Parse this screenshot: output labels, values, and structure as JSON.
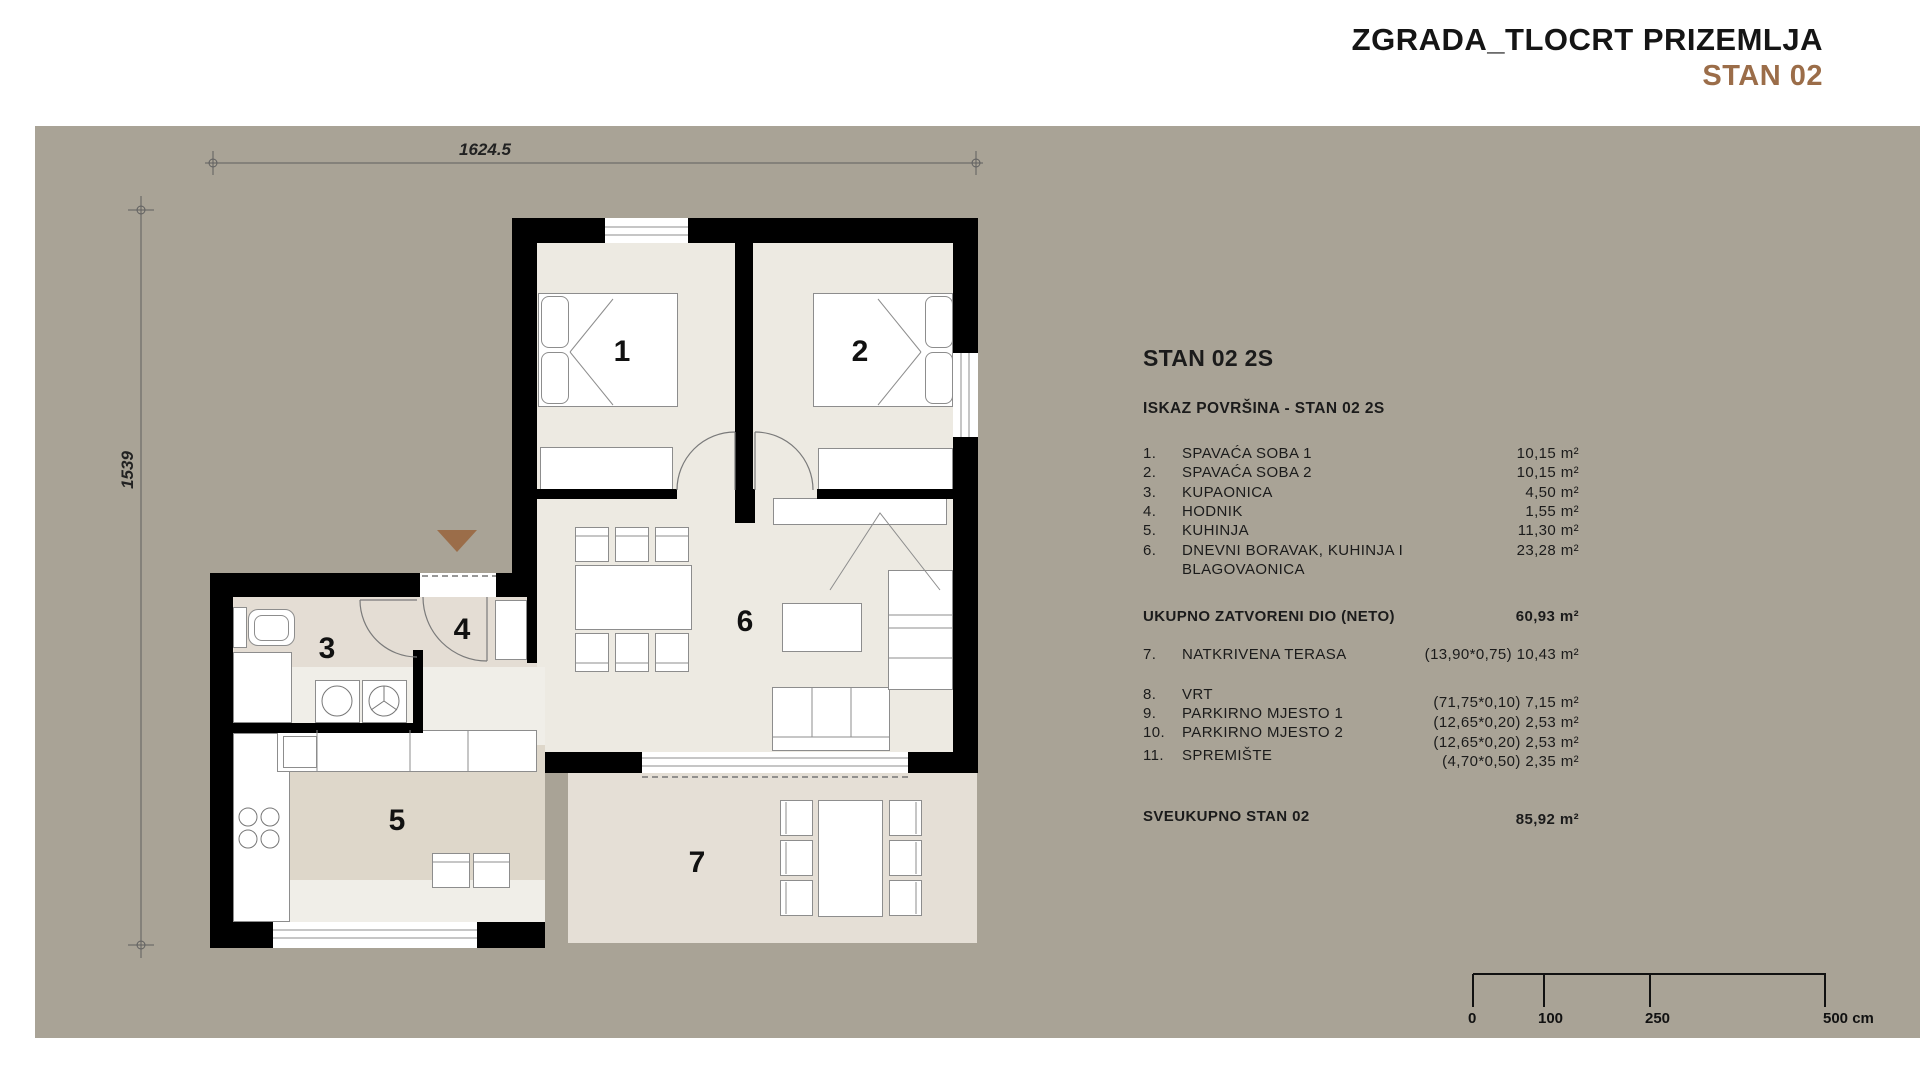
{
  "title": {
    "line1": "ZGRADA_TLOCRT PRIZEMLJA",
    "line2": "STAN 02"
  },
  "plan": {
    "dim_width": "1624.5",
    "dim_height": "1539",
    "rooms": [
      "1",
      "2",
      "3",
      "4",
      "5",
      "6",
      "7"
    ]
  },
  "panel": {
    "heading": "STAN 02 2S",
    "subheading": "ISKAZ POVRŠINA - STAN 02 2S",
    "items": [
      {
        "no": "1.",
        "name": "SPAVAĆA SOBA 1",
        "value": "10,15 m²"
      },
      {
        "no": "2.",
        "name": "SPAVAĆA SOBA 2",
        "value": "10,15 m²"
      },
      {
        "no": "3.",
        "name": "KUPAONICA",
        "value": "4,50 m²"
      },
      {
        "no": "4.",
        "name": "HODNIK",
        "value": "1,55 m²"
      },
      {
        "no": "5.",
        "name": "KUHINJA",
        "value": "11,30 m²"
      },
      {
        "no": "6.",
        "name": "DNEVNI BORAVAK, KUHINJA I",
        "name2": "BLAGOVAONICA",
        "value": "23,28 m²"
      }
    ],
    "subtotal": {
      "label": "UKUPNO ZATVORENI DIO (NETO)",
      "value": "60,93 m²"
    },
    "covered_terrace": {
      "no": "7.",
      "name": "NATKRIVENA TERASA",
      "value": "(13,90*0,75) 10,43 m²"
    },
    "outdoor_items": [
      {
        "no": "8.",
        "name": "VRT",
        "value": "(71,75*0,10) 7,15 m²"
      },
      {
        "no": "9.",
        "name": "PARKIRNO MJESTO 1",
        "value": "(12,65*0,20) 2,53 m²"
      },
      {
        "no": "10.",
        "name": "PARKIRNO MJESTO 2",
        "value": "(12,65*0,20) 2,53 m²"
      },
      {
        "no": "11.",
        "name": "SPREMIŠTE",
        "value": "(4,70*0,50) 2,35 m²"
      }
    ],
    "total": {
      "label": "SVEUKUPNO STAN 02",
      "value": "85,92 m²"
    }
  },
  "scalebar": {
    "labels": [
      "0",
      "100",
      "250",
      "500 cm"
    ]
  },
  "colors": {
    "canvas": "#a9a396",
    "wall": "#000000",
    "accent_brown": "#9b6d49",
    "floor_light": "#edeae2",
    "floor_warm": "#e4ddd4",
    "floor_kitchen": "#ded7ca",
    "floor_terrace": "#e5dfd6"
  }
}
